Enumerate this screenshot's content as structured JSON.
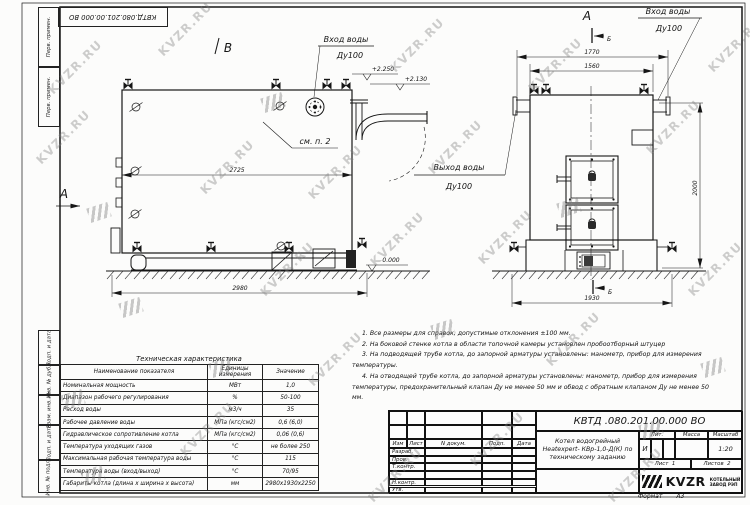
{
  "watermark": {
    "text": "KVZR.RU"
  },
  "frame": {
    "top_stamp": "КВТД.080.201.00.000 ВО",
    "left_strips_top": [
      "Перв. примен.",
      "Перв. примен."
    ],
    "left_strips_bottom": [
      "Подп. и дата",
      "Инв. № дубл.",
      "Взам. инв. №",
      "Подп. и дата",
      "Инв. № подл."
    ],
    "format_label": "Формат",
    "format_value": "А3"
  },
  "drawing": {
    "views": {
      "view_a": "А",
      "view_b": "В",
      "section_b": "Б"
    },
    "labels": {
      "inlet_line1": "Вход воды",
      "inlet_line2": "Ду100",
      "outlet_line1": "Выход воды",
      "outlet_line2": "Ду100",
      "see_note": "см. п. 2"
    },
    "elevations": {
      "top_left": "+2.250",
      "top_right": "+2.130",
      "ground": "0.000"
    },
    "dimensions": {
      "side_length": "2725",
      "side_overall": "2980",
      "front_width_outer": "1770",
      "front_width": "1560",
      "front_base": "1930",
      "front_height": "2000"
    }
  },
  "tech_table": {
    "title": "Техническая характеристика",
    "headers": [
      "Наименование показателя",
      "Единицы измерения",
      "Значение"
    ],
    "rows": [
      [
        "Номинальная мощность",
        "МВт",
        "1,0"
      ],
      [
        "Диапазон рабочего регулирования",
        "%",
        "50-100"
      ],
      [
        "Расход воды",
        "м3/ч",
        "35"
      ],
      [
        "Рабочее давление воды",
        "МПа (кгс/см2)",
        "0,6 (6,0)"
      ],
      [
        "Гидравлическое сопротивление котла",
        "МПа (кгс/см2)",
        "0,06 (0,6)"
      ],
      [
        "Температура уходящих газов",
        "°С",
        "не более 250"
      ],
      [
        "Максимальная рабочая температура воды",
        "°С",
        "115"
      ],
      [
        "Температура воды (вход/выход)",
        "°С",
        "70/95"
      ],
      [
        "Габариты котла (длина х ширина х высота)",
        "мм",
        "2980х1930х2250"
      ]
    ]
  },
  "notes": [
    "1. Все размеры для справок, допустимые отклонения ±100 мм.",
    "2. На боковой стенке котла в области топочной камеры установлен пробоотборный штуцер",
    "3. На подводящей трубе котла, до запорной арматуры установлены: манометр, прибор для измерения температуры.",
    "4. На отводящей трубе котла, до запорной арматуры установлены: манометр, прибор для измерения температуры, предохранительный клапан Ду не менее 50 мм и обвод с обратным клапаном Ду не менее 50 мм."
  ],
  "title_block": {
    "doc_number": "КВТД .080.201.00.000  ВО",
    "row_headers": [
      "Изм",
      "Лист",
      "N докум.",
      "Подп.",
      "Дата"
    ],
    "role_rows": [
      "Разраб.",
      "Пров.",
      "Т.контр.",
      "",
      "Н.контр.",
      "Утв."
    ],
    "name_lines": [
      "Котел водогрейный",
      "Heatexpert- КВр-1,0-Д(К) по",
      "техническому заданию"
    ],
    "lit_header": "Лит.",
    "mass_header": "Масса",
    "scale_header": "Масштаб",
    "lit_value": "И",
    "scale_value": "1:20",
    "sheet_label": "Лист",
    "sheet_value": "1",
    "sheets_label": "Листов",
    "sheets_value": "2",
    "logo_text": "KVZR",
    "company_line1": "КОТЕЛЬНЫЙ",
    "company_line2": "ЗАВОД РЭП"
  }
}
